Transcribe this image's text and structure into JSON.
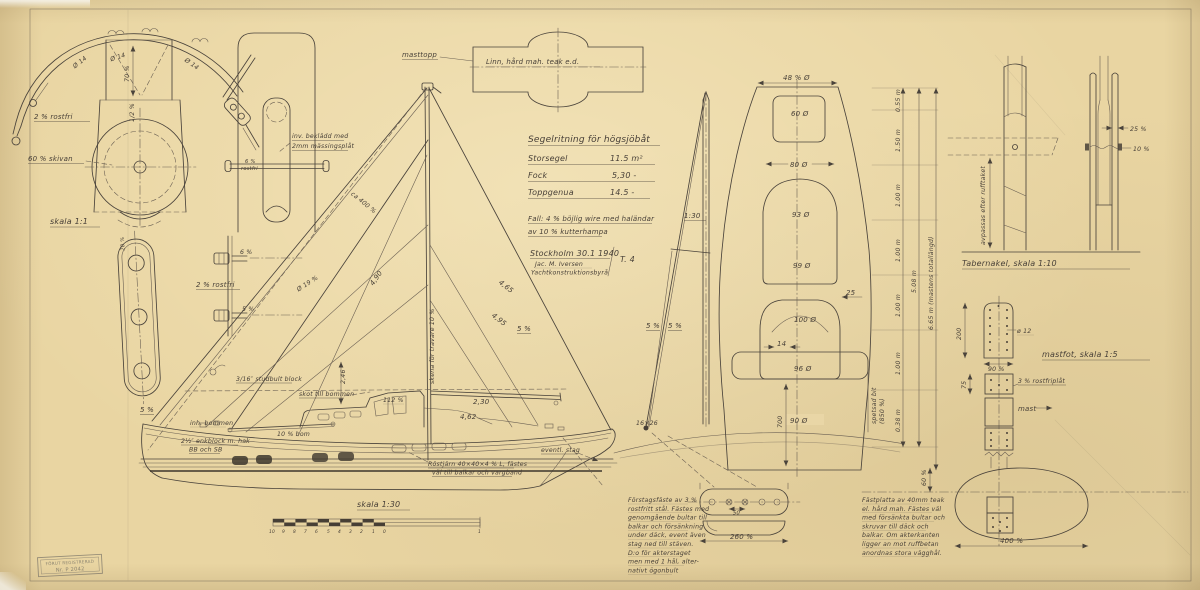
{
  "crane": {
    "d14_left": "Ø 14",
    "d14_mid": "Ø 14",
    "d14_right": "Ø 14",
    "dim_70": "70 %",
    "dim_half": "1/2 %",
    "rostfri": "2 % rostfri",
    "skiva": "60 % skivan",
    "scale": "skala 1:1"
  },
  "masthead_side": {
    "axle1": "6 %",
    "axle2": "rostfri",
    "note1": "inv. beklädd med",
    "note2": "2mm mässingsplåt"
  },
  "tang": {
    "dim20": "20 %"
  },
  "bolts": {
    "b6": "6 %",
    "b5": "5 %",
    "rostfri": "2 % rostfri",
    "d19": "Ø 19 %"
  },
  "profile": {
    "shroud5": "5 %",
    "bommen_inh": "inh. bommen",
    "block1": "3/16″ studbult block",
    "enkblock1": "2½″ enkblock m. hak",
    "enkblock2": "BB och SB",
    "skot": "skot till bommen",
    "bom10": "10 % bom",
    "dim112": "112 %",
    "dim246": "2,46",
    "dim490": "4,90",
    "dim465": "4,65",
    "dim495": "4,95",
    "stay5": "5 %",
    "dim230": "2,30",
    "dim462": "4,62",
    "ca400": "ca 400 %",
    "skena": "skena för travare 10 %",
    "rostjarn1": "Röstjärn 40×40×4 % L, fästes",
    "rostjarn2": "väl till balkar och vargband",
    "eventl": "eventl. stag"
  },
  "scalebar": {
    "label": "skala 1:30",
    "ticks": [
      "10",
      "9",
      "8",
      "7",
      "6",
      "5",
      "4",
      "3",
      "2",
      "1",
      "0"
    ],
    "right": "1"
  },
  "masttopp": {
    "label": "masttopp",
    "material": "Linn, hård mah. teak e.d."
  },
  "spec": {
    "title": "Segelritning för högsjöbåt",
    "rows": [
      {
        "name": "Storsegel",
        "value": "11.5 m²"
      },
      {
        "name": "Fock",
        "value": "5,30 -"
      },
      {
        "name": "Toppgenua",
        "value": "14.5 -"
      }
    ],
    "note1": "Fall: 4 % böjlig wire med haländar",
    "note2": "av 10 % kutterhampa",
    "place_date": "Stockholm 30.1 1940",
    "signature1": "Jac. M. Iversen",
    "signature2": "Yachtkonstruktionsbyrå",
    "sheet_no": "T. 4"
  },
  "rig_front": {
    "scale": "1:30",
    "left5": "5 %",
    "right5": "5 %",
    "foot": "16×26"
  },
  "mast_section": {
    "d48": "48 % Ø",
    "d60": "60 Ø",
    "d80": "80 Ø",
    "d93": "93 Ø",
    "d99": "99 Ø",
    "d25": "25",
    "d100": "100 Ø",
    "d14": "14",
    "d96": "96 Ø",
    "d90": "90 Ø",
    "len700": "700",
    "spets1": "spetsad bit",
    "spets2": "(850 %)",
    "seg": [
      "0.55 m",
      "1.50 m",
      "1.00 m",
      "1.00 m",
      "1.00 m",
      "1.00 m",
      "0.38 m"
    ],
    "total508": "5.08 m",
    "total665": "6.65 m (mastens totallängd)"
  },
  "tabernacle": {
    "d25": "25 %",
    "d10": "10 %",
    "note": "avpassas efter rufftaket",
    "label": "Tabernakel, skala 1:10"
  },
  "mastfot": {
    "label": "mastfot, skala 1:5",
    "d12": "ø 12",
    "len200": "200",
    "w90": "90 %",
    "h75": "75",
    "plate": "3 % rostfriplåt",
    "mast": "mast",
    "d60": "60 %",
    "w400": "400 %"
  },
  "forestay": {
    "d50": "50",
    "w260": "260 %",
    "text": [
      "Förstagsfäste av 3 %",
      "rostfritt stål. Fästes med",
      "genomgående bultar till",
      "balkar och försänkning",
      "under däck, event även",
      "stag ned till stäven.",
      "D:o för akterstaget",
      "men med 1 hål, alter-",
      "nativt ögonbult"
    ]
  },
  "footplate": {
    "text": [
      "Fästplatta av 40mm teak",
      "el. hård mah. Fästes väl",
      "med försänkta bultar och",
      "skruvar till däck och",
      "balkar. Om akterkanten",
      "ligger an mot ruffbetan",
      "anordnas stora vägghål."
    ]
  },
  "stamp": {
    "line1": "FÖRUT REGISTRERAD",
    "line2": "Nr. P 2042"
  }
}
